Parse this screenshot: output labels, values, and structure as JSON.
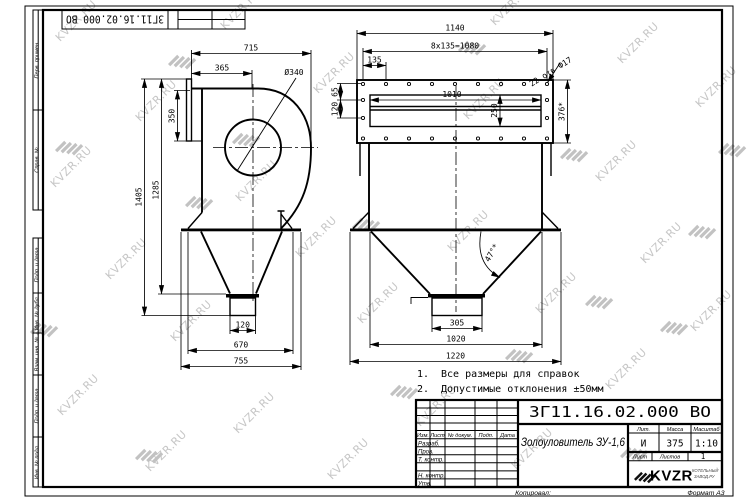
{
  "watermark": {
    "text": "KVZR.RU"
  },
  "corner_stamp": {
    "designation": "ЗГ11.16.02.000 ВО"
  },
  "margin_labels": {
    "perv_primen": "Перв. примен.",
    "sprav_no": "Справ. №",
    "podp_data_top": "Подп. и дата",
    "inv_no_dubl": "Инв. № дубл.",
    "vzam_inv_no": "Взам. инв. №",
    "podp_data_bottom": "Подп. и дата",
    "inv_no_podl": "Инв. № подл."
  },
  "left_view": {
    "dims": {
      "w715": "715",
      "w365": "365",
      "dia340": "Ø340",
      "h350": "350",
      "h1285": "1285",
      "h1405": "1405",
      "w120": "120",
      "w670": "670",
      "w755": "755"
    }
  },
  "right_view": {
    "dims": {
      "w1140": "1140",
      "holes_pitch": "8x135=1080",
      "w135": "135",
      "w1010": "1010",
      "h65": "65",
      "h120": "120",
      "h250": "250",
      "h376": "376*",
      "holes_note": "22 отв Ф17",
      "angle": "47°*",
      "w305": "305",
      "w1020": "1020",
      "w1220": "1220"
    }
  },
  "notes": {
    "n1_no": "1.",
    "n1_text": "Все размеры для справок",
    "n2_no": "2.",
    "n2_text": "Допустимые отклонения ±50мм"
  },
  "title_block": {
    "designation": "ЗГ11.16.02.000 ВО",
    "product_name": "Золоуловитель ЗУ-1,6",
    "cols": {
      "izm": "Изм.",
      "list": "Лист",
      "n_dokum": "№ докум.",
      "podp": "Подп.",
      "data": "Дата"
    },
    "rows": {
      "razrab": "Разраб.",
      "prov": "Пров.",
      "t_kontr": "Т. контр.",
      "n_kontr": "Н. контр.",
      "utv": "Утв."
    },
    "lit_label": "Лит.",
    "massa_label": "Масса",
    "masshtab_label": "Масштаб",
    "lit_value": "И",
    "massa_value": "375",
    "masshtab_value": "1:10",
    "list_label": "Лист",
    "listov_label": "Листов",
    "listov_value": "1",
    "logo_text": "KVZR",
    "logo_sub_line1": "КОТЕЛЬНЫЙ",
    "logo_sub_line2": "ЗАВОД.РУ",
    "kopiroval": "Копировал:",
    "format": "Формат А3"
  }
}
